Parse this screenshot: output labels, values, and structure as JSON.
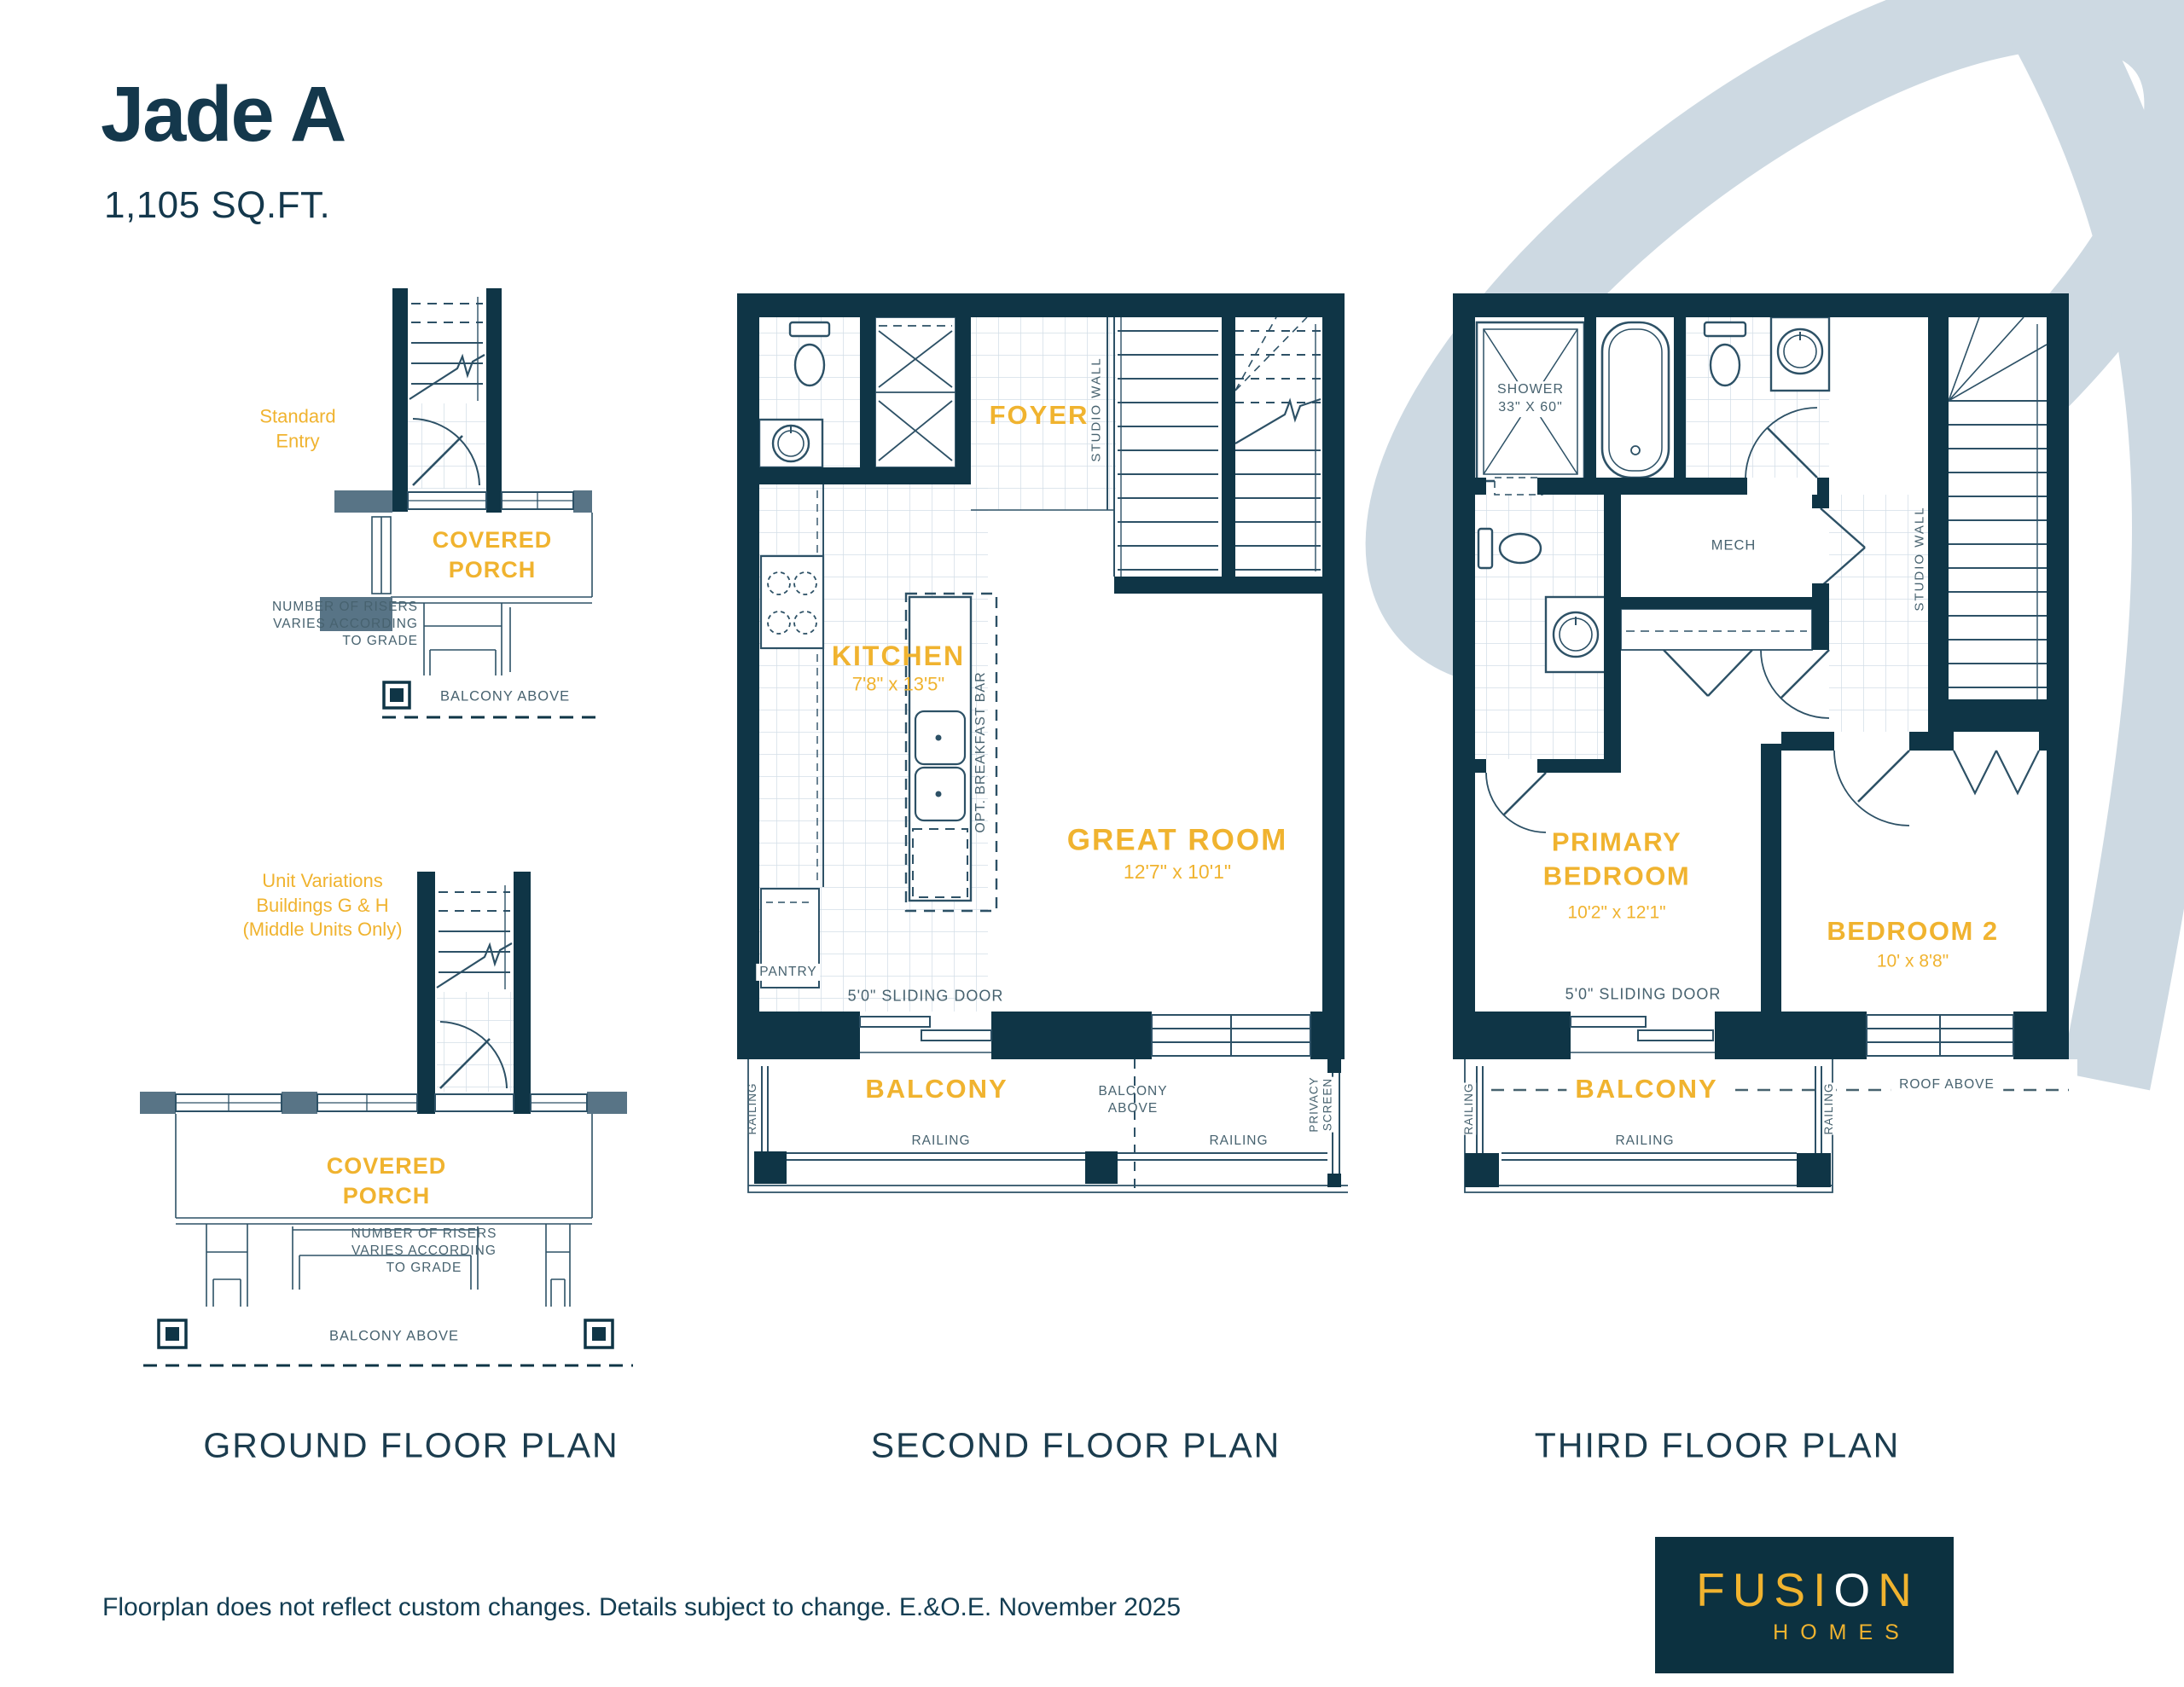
{
  "header": {
    "plan_name": "Jade A",
    "area": "1,105 SQ.FT."
  },
  "colors": {
    "navy_walls": "#0F3546",
    "gold_labels": "#F0B32F",
    "annotation_gray": "#47626F",
    "porch_gray": "#587486",
    "swoosh_blue": "#CDD9E2",
    "logo_background": "#0C3140"
  },
  "ground": {
    "title": "GROUND FLOOR PLAN",
    "standard_entry": "Standard\nEntry",
    "covered_porch": "COVERED\nPORCH",
    "risers_note": "NUMBER OF RISERS\nVARIES ACCORDING\nTO GRADE",
    "balcony_above": "BALCONY ABOVE",
    "unit_variations": "Unit Variations\nBuildings G & H\n(Middle Units Only)"
  },
  "second": {
    "title": "SECOND FLOOR PLAN",
    "foyer": "FOYER",
    "kitchen": "KITCHEN",
    "kitchen_dims": "7'8\" x 13'5\"",
    "great_room": "GREAT ROOM",
    "great_room_dims": "12'7\" x 10'1\"",
    "studio_wall": "STUDIO WALL",
    "breakfast_bar": "OPT. BREAKFAST BAR",
    "pantry": "PANTRY",
    "sliding_door": "5'0\" SLIDING DOOR",
    "balcony": "BALCONY",
    "balcony_above": "BALCONY\nABOVE",
    "privacy_screen": "PRIVACY\nSCREEN",
    "railing": "RAILING"
  },
  "third": {
    "title": "THIRD FLOOR PLAN",
    "shower": "SHOWER\n33\" X 60\"",
    "mech": "MECH",
    "studio_wall": "STUDIO WALL",
    "primary_bedroom": "PRIMARY\nBEDROOM",
    "primary_dims": "10'2\" x 12'1\"",
    "bedroom2": "BEDROOM 2",
    "bedroom2_dims": "10' x 8'8\"",
    "sliding_door": "5'0\" SLIDING DOOR",
    "balcony": "BALCONY",
    "roof_above": "ROOF ABOVE",
    "railing": "RAILING"
  },
  "footer": {
    "disclaimer": "Floorplan does not reflect custom changes. Details subject to change. E.&O.E. November 2025",
    "logo": {
      "brand_start": "FUSI",
      "brand_o": "O",
      "brand_end": "N",
      "sub": "HOMES"
    }
  }
}
